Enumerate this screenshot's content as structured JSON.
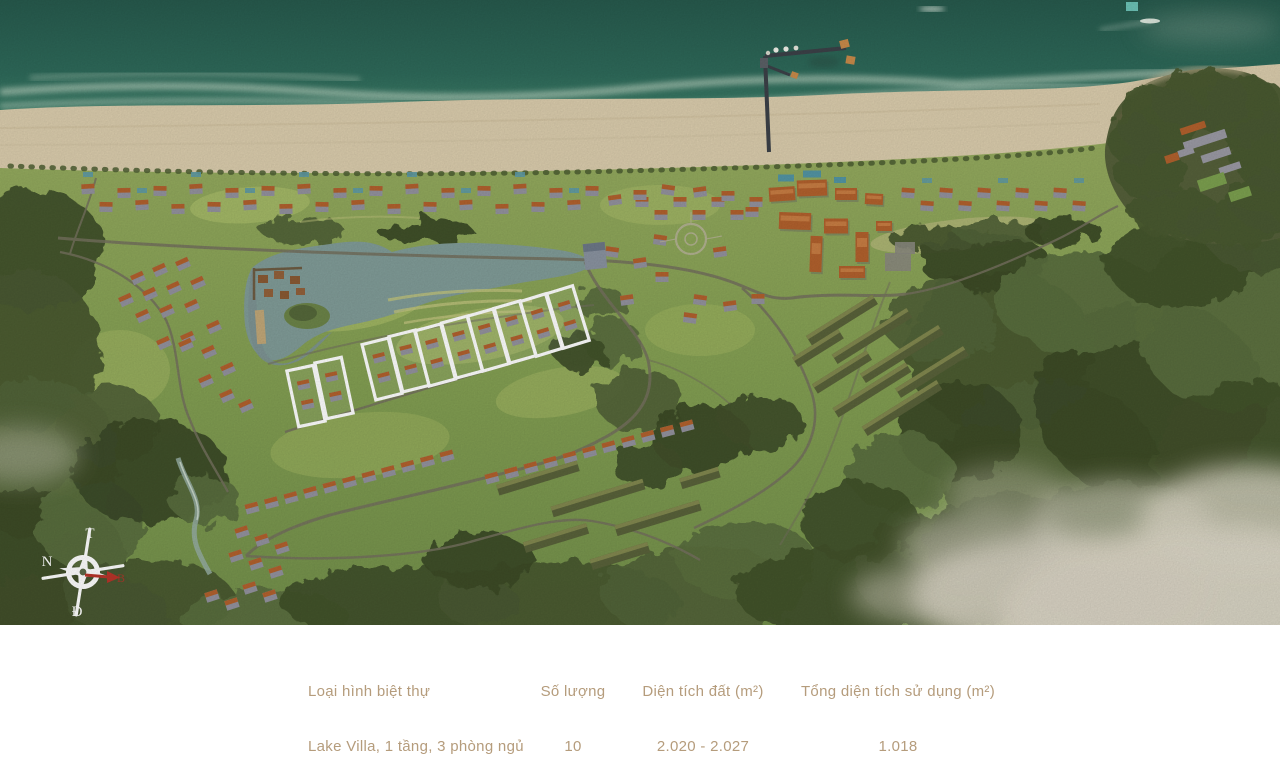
{
  "map": {
    "compass": {
      "top": "T",
      "left": "N",
      "bottom": "Đ",
      "right": "B"
    },
    "highlighted_plot_count": 10
  },
  "table": {
    "headers": [
      "Loại hình biệt thự",
      "Số lượng",
      "Diện tích đất (m²)",
      "Tổng diện tích sử dụng (m²)"
    ],
    "rows": [
      [
        "Lake Villa, 1 tầng, 3 phòng ngủ",
        "10",
        "2.020 - 2.027",
        "1.018"
      ]
    ]
  },
  "colors": {
    "table_text": "#b59c7c",
    "sea_deep": "#29604f",
    "sea_shallow": "#9fc7a6",
    "sand": "#dbcdad",
    "grass": "#8ba45a",
    "forest": "#46572e",
    "villa_roof": "#b2612d",
    "lake_water": "#819c98",
    "plot_outline": "#ffffff",
    "compass_red": "#b8352a"
  }
}
